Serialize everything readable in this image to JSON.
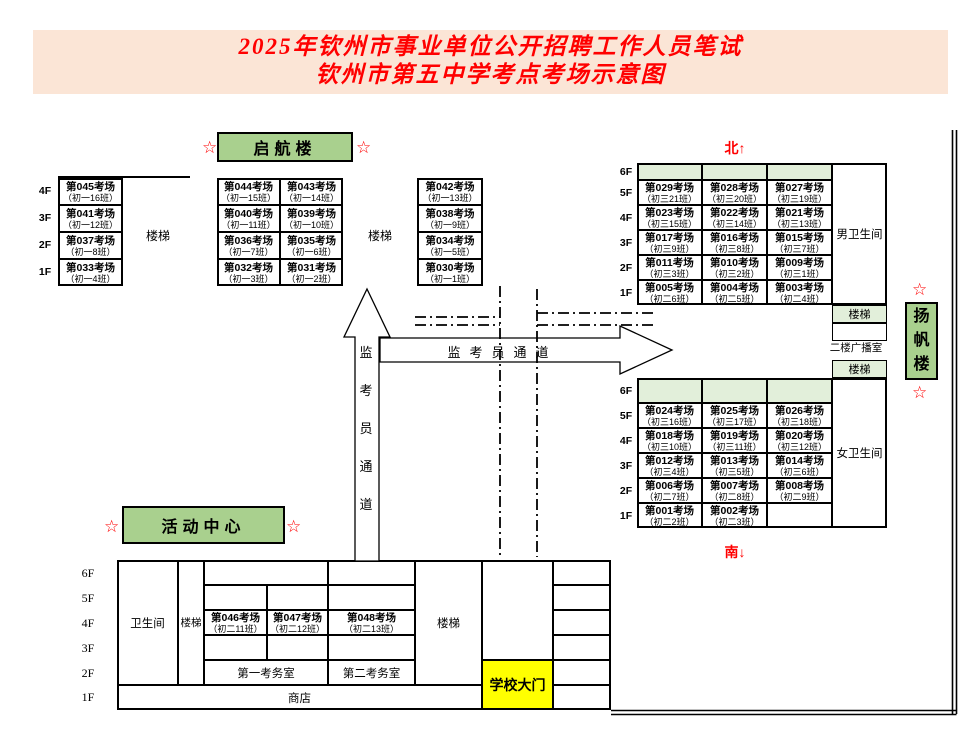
{
  "title": {
    "line1": "2025年钦州市事业单位公开招聘工作人员笔试",
    "line2": "钦州市第五中学考点考场示意图"
  },
  "compass": {
    "north": "北↑",
    "south": "南↓"
  },
  "star": "☆",
  "floors": {
    "f6": "6F",
    "f5": "5F",
    "f4": "4F",
    "f3": "3F",
    "f2": "2F",
    "f1": "1F"
  },
  "labels": {
    "stairs": "楼梯",
    "restroom": "卫生间",
    "restroom_men": "男卫生间",
    "restroom_women": "女卫生间",
    "broadcast_room": "二楼广播室",
    "exam_office_1": "第一考务室",
    "exam_office_2": "第二考务室",
    "shop": "商店",
    "school_gate": "学校大门",
    "corridor": "监考员通道"
  },
  "colors": {
    "title_bg": "#FBE5D6",
    "title_text": "#FF0000",
    "building_label_green": "#A9D08E",
    "cell_green": "#E2EFDA",
    "gate_yellow": "#FFFF00",
    "compass_red": "#FF0000"
  },
  "buildings": {
    "qihang": {
      "name": "启航楼",
      "left_wing_cells": [
        {
          "room": "第044考场",
          "class": "（初一15班）"
        },
        {
          "room": "第043考场",
          "class": "（初一14班）"
        },
        {
          "room": "第040考场",
          "class": "（初一11班）"
        },
        {
          "room": "第039考场",
          "class": "（初一10班）"
        },
        {
          "room": "第036考场",
          "class": "（初一7班）"
        },
        {
          "room": "第035考场",
          "class": "（初一6班）"
        },
        {
          "room": "第032考场",
          "class": "（初一3班）"
        },
        {
          "room": "第031考场",
          "class": "（初一2班）"
        }
      ],
      "right_wing_cells": [
        {
          "room": "第042考场",
          "class": "（初一13班）"
        },
        {
          "room": "第038考场",
          "class": "（初一9班）"
        },
        {
          "room": "第034考场",
          "class": "（初一5班）"
        },
        {
          "room": "第030考场",
          "class": "（初一1班）"
        }
      ]
    },
    "west_annex": {
      "cells": [
        {
          "room": "第045考场",
          "class": "（初一16班）"
        },
        {
          "room": "第041考场",
          "class": "（初一12班）"
        },
        {
          "room": "第037考场",
          "class": "（初一8班）"
        },
        {
          "room": "第033考场",
          "class": "（初一4班）"
        }
      ]
    },
    "yangfan": {
      "name": "扬帆楼",
      "north_cells": [
        {
          "room": "第029考场",
          "class": "（初三21班）"
        },
        {
          "room": "第028考场",
          "class": "（初三20班）"
        },
        {
          "room": "第027考场",
          "class": "（初三19班）"
        },
        {
          "room": "第023考场",
          "class": "（初三15班）"
        },
        {
          "room": "第022考场",
          "class": "（初三14班）"
        },
        {
          "room": "第021考场",
          "class": "（初三13班）"
        },
        {
          "room": "第017考场",
          "class": "（初三9班）"
        },
        {
          "room": "第016考场",
          "class": "（初三8班）"
        },
        {
          "room": "第015考场",
          "class": "（初三7班）"
        },
        {
          "room": "第011考场",
          "class": "（初三3班）"
        },
        {
          "room": "第010考场",
          "class": "（初三2班）"
        },
        {
          "room": "第009考场",
          "class": "（初三1班）"
        },
        {
          "room": "第005考场",
          "class": "（初二6班）"
        },
        {
          "room": "第004考场",
          "class": "（初二5班）"
        },
        {
          "room": "第003考场",
          "class": "（初二4班）"
        }
      ],
      "south_cells": [
        {
          "room": "第024考场",
          "class": "（初三16班）"
        },
        {
          "room": "第025考场",
          "class": "（初三17班）"
        },
        {
          "room": "第026考场",
          "class": "（初三18班）"
        },
        {
          "room": "第018考场",
          "class": "（初三10班）"
        },
        {
          "room": "第019考场",
          "class": "（初三11班）"
        },
        {
          "room": "第020考场",
          "class": "（初三12班）"
        },
        {
          "room": "第012考场",
          "class": "（初三4班）"
        },
        {
          "room": "第013考场",
          "class": "（初三5班）"
        },
        {
          "room": "第014考场",
          "class": "（初三6班）"
        },
        {
          "room": "第006考场",
          "class": "（初二7班）"
        },
        {
          "room": "第007考场",
          "class": "（初二8班）"
        },
        {
          "room": "第008考场",
          "class": "（初二9班）"
        },
        {
          "room": "第001考场",
          "class": "（初二2班）"
        },
        {
          "room": "第002考场",
          "class": "（初二3班）"
        },
        {
          "room": "",
          "class": ""
        }
      ]
    },
    "activity_center": {
      "name": "活动中心",
      "cells_4f": [
        {
          "room": "第046考场",
          "class": "（初二11班）"
        },
        {
          "room": "第047考场",
          "class": "（初二12班）"
        },
        {
          "room": "第048考场",
          "class": "（初二13班）"
        }
      ]
    }
  }
}
